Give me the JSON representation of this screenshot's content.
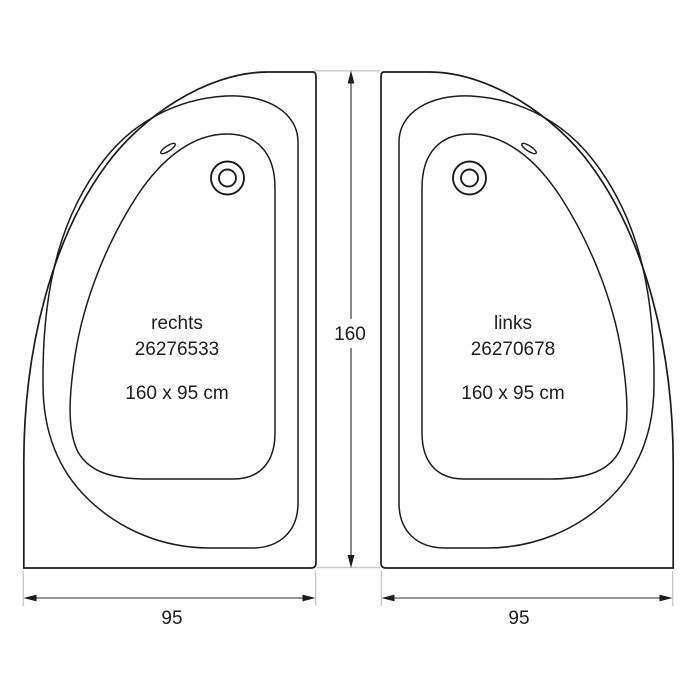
{
  "drawing": {
    "left_tub": {
      "orientation": "rechts",
      "article_number": "26276533",
      "size": "160 x 95 cm"
    },
    "right_tub": {
      "orientation": "links",
      "article_number": "26270678",
      "size": "160 x 95 cm"
    },
    "dimensions": {
      "height": "160",
      "width_left": "95",
      "width_right": "95"
    },
    "colors": {
      "line": "#1c1c1c",
      "dim_line_v": "#474747",
      "dim_line_h": "#979797",
      "extension_line": "#c9c9c9",
      "text": "#1c1c1c",
      "background": "#ffffff"
    }
  }
}
